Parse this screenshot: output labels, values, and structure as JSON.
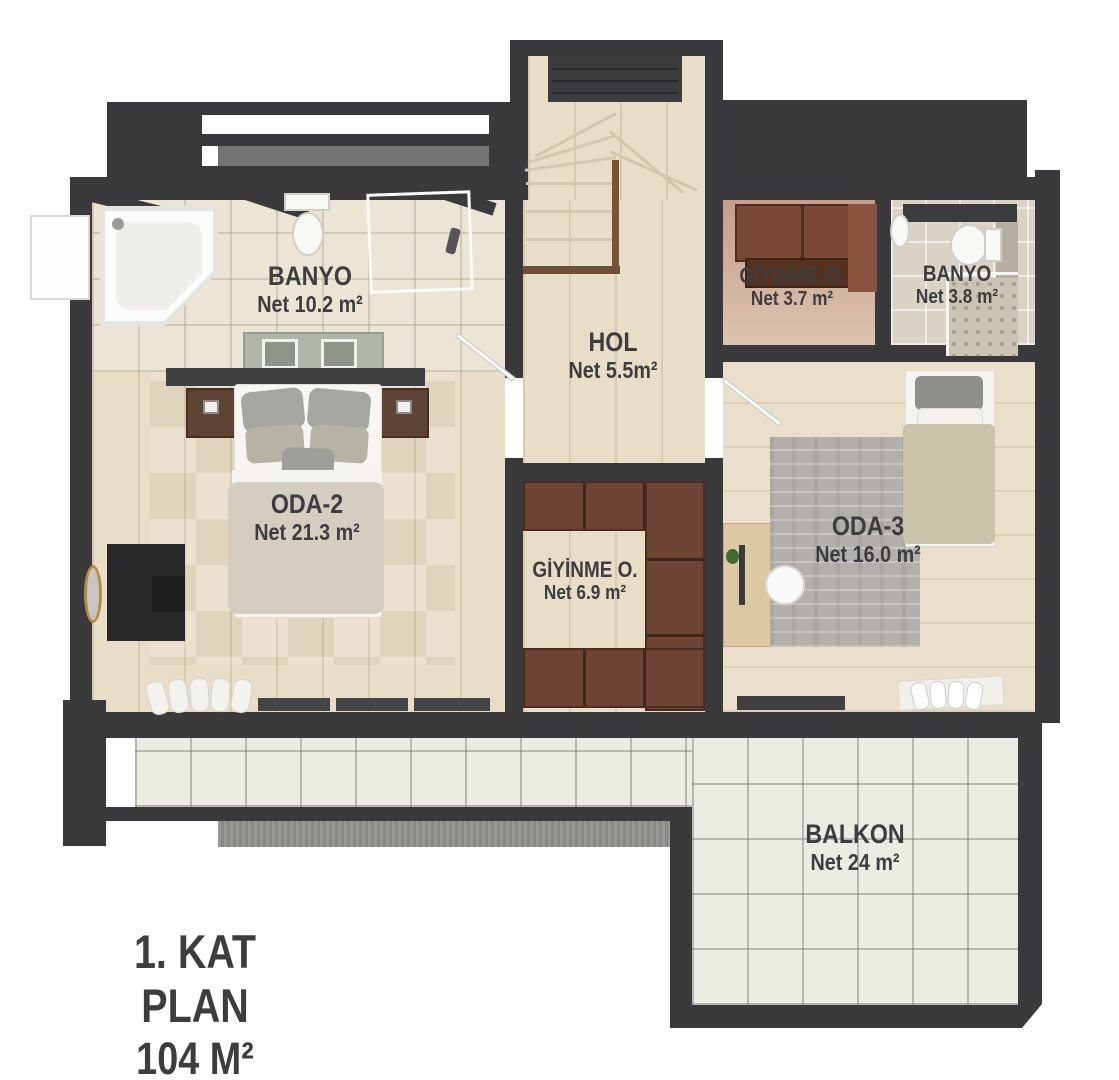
{
  "title": {
    "line1": "1. KAT PLAN",
    "line2": "104 M²"
  },
  "rooms": {
    "banyo_sol": {
      "name": "BANYO",
      "area": "Net 10.2 m²"
    },
    "hol": {
      "name": "HOL",
      "area": "Net 5.5m²"
    },
    "giyinme_ust": {
      "name": "GİYİNME O.",
      "area": "Net 3.7 m²"
    },
    "banyo_sag": {
      "name": "BANYO",
      "area": "Net 3.8 m²"
    },
    "oda2": {
      "name": "ODA-2",
      "area": "Net 21.3 m²"
    },
    "giyinme_orta": {
      "name": "GİYİNME O.",
      "area": "Net 6.9 m²"
    },
    "oda3": {
      "name": "ODA-3",
      "area": "Net 16.0 m²"
    },
    "balkon": {
      "name": "BALKON",
      "area": "Net 24 m²"
    }
  },
  "colors": {
    "wall": "#3a3a3c",
    "text": "#3d3d40",
    "wood_floor": "#e8ddc7",
    "bath_tile": "#ebe5d5",
    "balcony_tile": "#edece4",
    "wardrobe_brown": "#6e4434",
    "concrete": "#90908c"
  }
}
